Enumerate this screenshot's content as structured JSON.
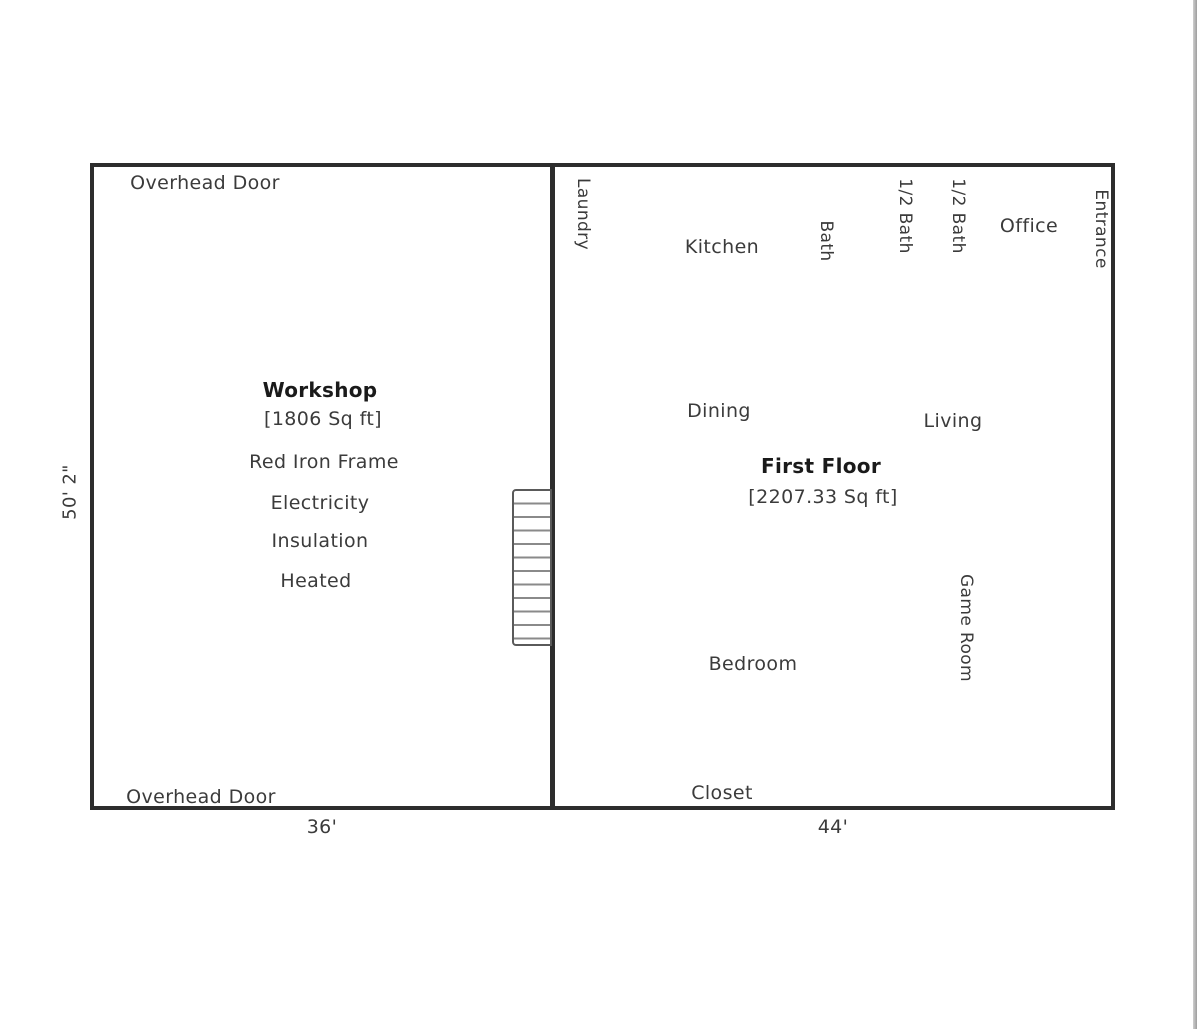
{
  "diagram": {
    "left_dimension": "50' 2\"",
    "workshop": {
      "overhead_door_top": "Overhead Door",
      "overhead_door_bottom": "Overhead Door",
      "title": "Workshop",
      "area": "[1806 Sq ft]",
      "features": [
        "Red Iron Frame",
        "Electricity",
        "Insulation",
        "Heated"
      ],
      "width_dimension": "36'"
    },
    "first_floor": {
      "title": "First Floor",
      "area": "[2207.33 Sq ft]",
      "width_dimension": "44'",
      "rooms": {
        "laundry": "Laundry",
        "kitchen": "Kitchen",
        "bath": "Bath",
        "half_bath_1": "1/2 Bath",
        "half_bath_2": "1/2 Bath",
        "office": "Office",
        "entrance": "Entrance",
        "dining": "Dining",
        "living": "Living",
        "game_room": "Game Room",
        "bedroom": "Bedroom",
        "closet": "Closet"
      }
    },
    "wall_color": "#2d2d2d",
    "text_color": "#3b3b3b"
  }
}
